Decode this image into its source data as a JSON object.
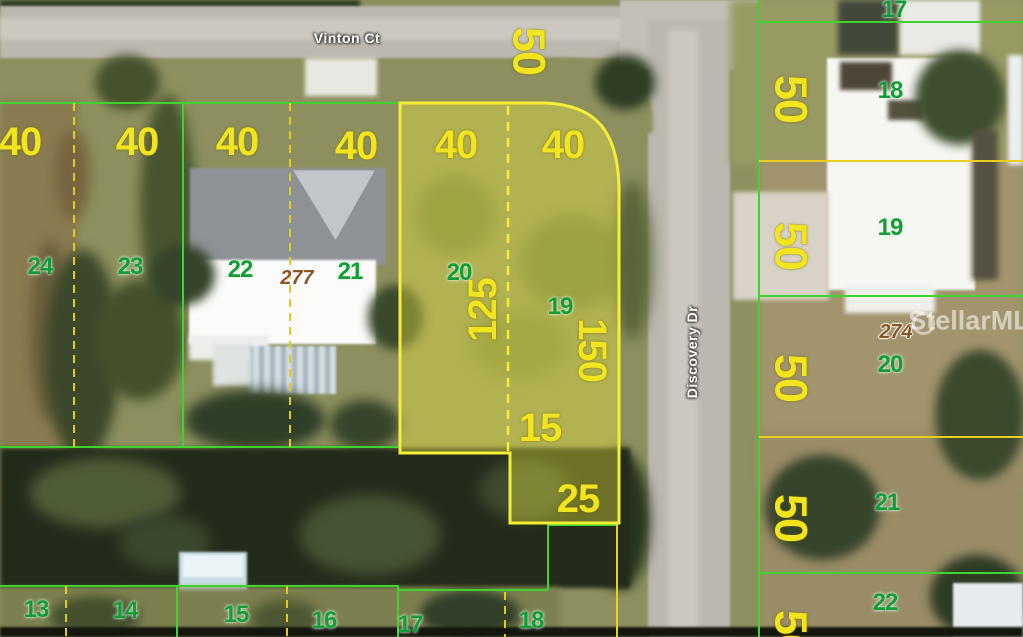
{
  "map": {
    "streets": {
      "horizontal": "Vinton Ct",
      "vertical": "Discovery Dr"
    },
    "watermark": "StellarMLS",
    "highlighted_parcel": {
      "lot_numbers": [
        "20",
        "19"
      ],
      "address": "277",
      "frontage_dimensions": [
        "40",
        "40"
      ],
      "side_dimensions": [
        "125",
        "150",
        "15",
        "25"
      ]
    },
    "colors": {
      "parcel_line_green": "#3ed32e",
      "dashed_line_yellow": "#e6c91f",
      "dimension_text_yellow": "#f2e41f",
      "lot_number_green": "#149c38",
      "address_brown": "#8a5423",
      "highlight_border": "#f4ee34",
      "highlight_fill": "rgba(244,238,60,0.36)"
    },
    "labels": [
      {
        "text": "Vinton Ct",
        "x": 347,
        "y": 38,
        "kind": "street",
        "rot": 0
      },
      {
        "text": "Discovery Dr",
        "x": 692,
        "y": 352,
        "kind": "street",
        "rot": -90
      },
      {
        "text": "40",
        "x": 20,
        "y": 142,
        "kind": "dim",
        "rot": 0
      },
      {
        "text": "40",
        "x": 137,
        "y": 142,
        "kind": "dim",
        "rot": 0
      },
      {
        "text": "40",
        "x": 237,
        "y": 142,
        "kind": "dim",
        "rot": 0
      },
      {
        "text": "40",
        "x": 356,
        "y": 146,
        "kind": "dim",
        "rot": 0
      },
      {
        "text": "40",
        "x": 456,
        "y": 145,
        "kind": "dim",
        "rot": 0
      },
      {
        "text": "40",
        "x": 563,
        "y": 145,
        "kind": "dim",
        "rot": 0
      },
      {
        "text": "15",
        "x": 540,
        "y": 428,
        "kind": "dim",
        "rot": 0
      },
      {
        "text": "25",
        "x": 578,
        "y": 499,
        "kind": "dim",
        "rot": 0
      },
      {
        "text": "125",
        "x": 483,
        "y": 310,
        "kind": "dim",
        "rot": -90
      },
      {
        "text": "150",
        "x": 592,
        "y": 350,
        "kind": "dim",
        "rot": 90
      },
      {
        "text": "50",
        "x": 529,
        "y": 51,
        "kind": "dim50",
        "rot": 90
      },
      {
        "text": "50",
        "x": 791,
        "y": 99,
        "kind": "dim50",
        "rot": 90
      },
      {
        "text": "50",
        "x": 791,
        "y": 246,
        "kind": "dim50",
        "rot": 90
      },
      {
        "text": "50",
        "x": 791,
        "y": 378,
        "kind": "dim50",
        "rot": 90
      },
      {
        "text": "50",
        "x": 791,
        "y": 518,
        "kind": "dim50",
        "rot": 90
      },
      {
        "text": "50",
        "x": 791,
        "y": 634,
        "kind": "dim50",
        "rot": 90
      },
      {
        "text": "24",
        "x": 40,
        "y": 267,
        "kind": "lot",
        "rot": 0
      },
      {
        "text": "23",
        "x": 130,
        "y": 267,
        "kind": "lot",
        "rot": 0
      },
      {
        "text": "22",
        "x": 240,
        "y": 270,
        "kind": "lot",
        "rot": 0
      },
      {
        "text": "21",
        "x": 350,
        "y": 272,
        "kind": "lot",
        "rot": 0
      },
      {
        "text": "20",
        "x": 459,
        "y": 273,
        "kind": "lot",
        "rot": 0
      },
      {
        "text": "19",
        "x": 560,
        "y": 307,
        "kind": "lot",
        "rot": 0
      },
      {
        "text": "17",
        "x": 894,
        "y": 10,
        "kind": "lot",
        "rot": 0
      },
      {
        "text": "18",
        "x": 890,
        "y": 91,
        "kind": "lot",
        "rot": 0
      },
      {
        "text": "19",
        "x": 890,
        "y": 228,
        "kind": "lot",
        "rot": 0
      },
      {
        "text": "20",
        "x": 890,
        "y": 365,
        "kind": "lot",
        "rot": 0
      },
      {
        "text": "21",
        "x": 887,
        "y": 503,
        "kind": "lot",
        "rot": 0
      },
      {
        "text": "22",
        "x": 885,
        "y": 603,
        "kind": "lot",
        "rot": 0
      },
      {
        "text": "13",
        "x": 36,
        "y": 610,
        "kind": "lot",
        "rot": 0
      },
      {
        "text": "14",
        "x": 125,
        "y": 611,
        "kind": "lot",
        "rot": 0
      },
      {
        "text": "15",
        "x": 236,
        "y": 615,
        "kind": "lot",
        "rot": 0
      },
      {
        "text": "16",
        "x": 324,
        "y": 621,
        "kind": "lot",
        "rot": 0
      },
      {
        "text": "17",
        "x": 410,
        "y": 625,
        "kind": "lot",
        "rot": 0
      },
      {
        "text": "18",
        "x": 531,
        "y": 621,
        "kind": "lot",
        "rot": 0
      },
      {
        "text": "277",
        "x": 297,
        "y": 278,
        "kind": "addr",
        "rot": 0
      },
      {
        "text": "274",
        "x": 896,
        "y": 332,
        "kind": "addr",
        "rot": 0
      },
      {
        "text": "StellarMLS",
        "x": 978,
        "y": 321,
        "kind": "watermark",
        "rot": 0
      }
    ]
  }
}
